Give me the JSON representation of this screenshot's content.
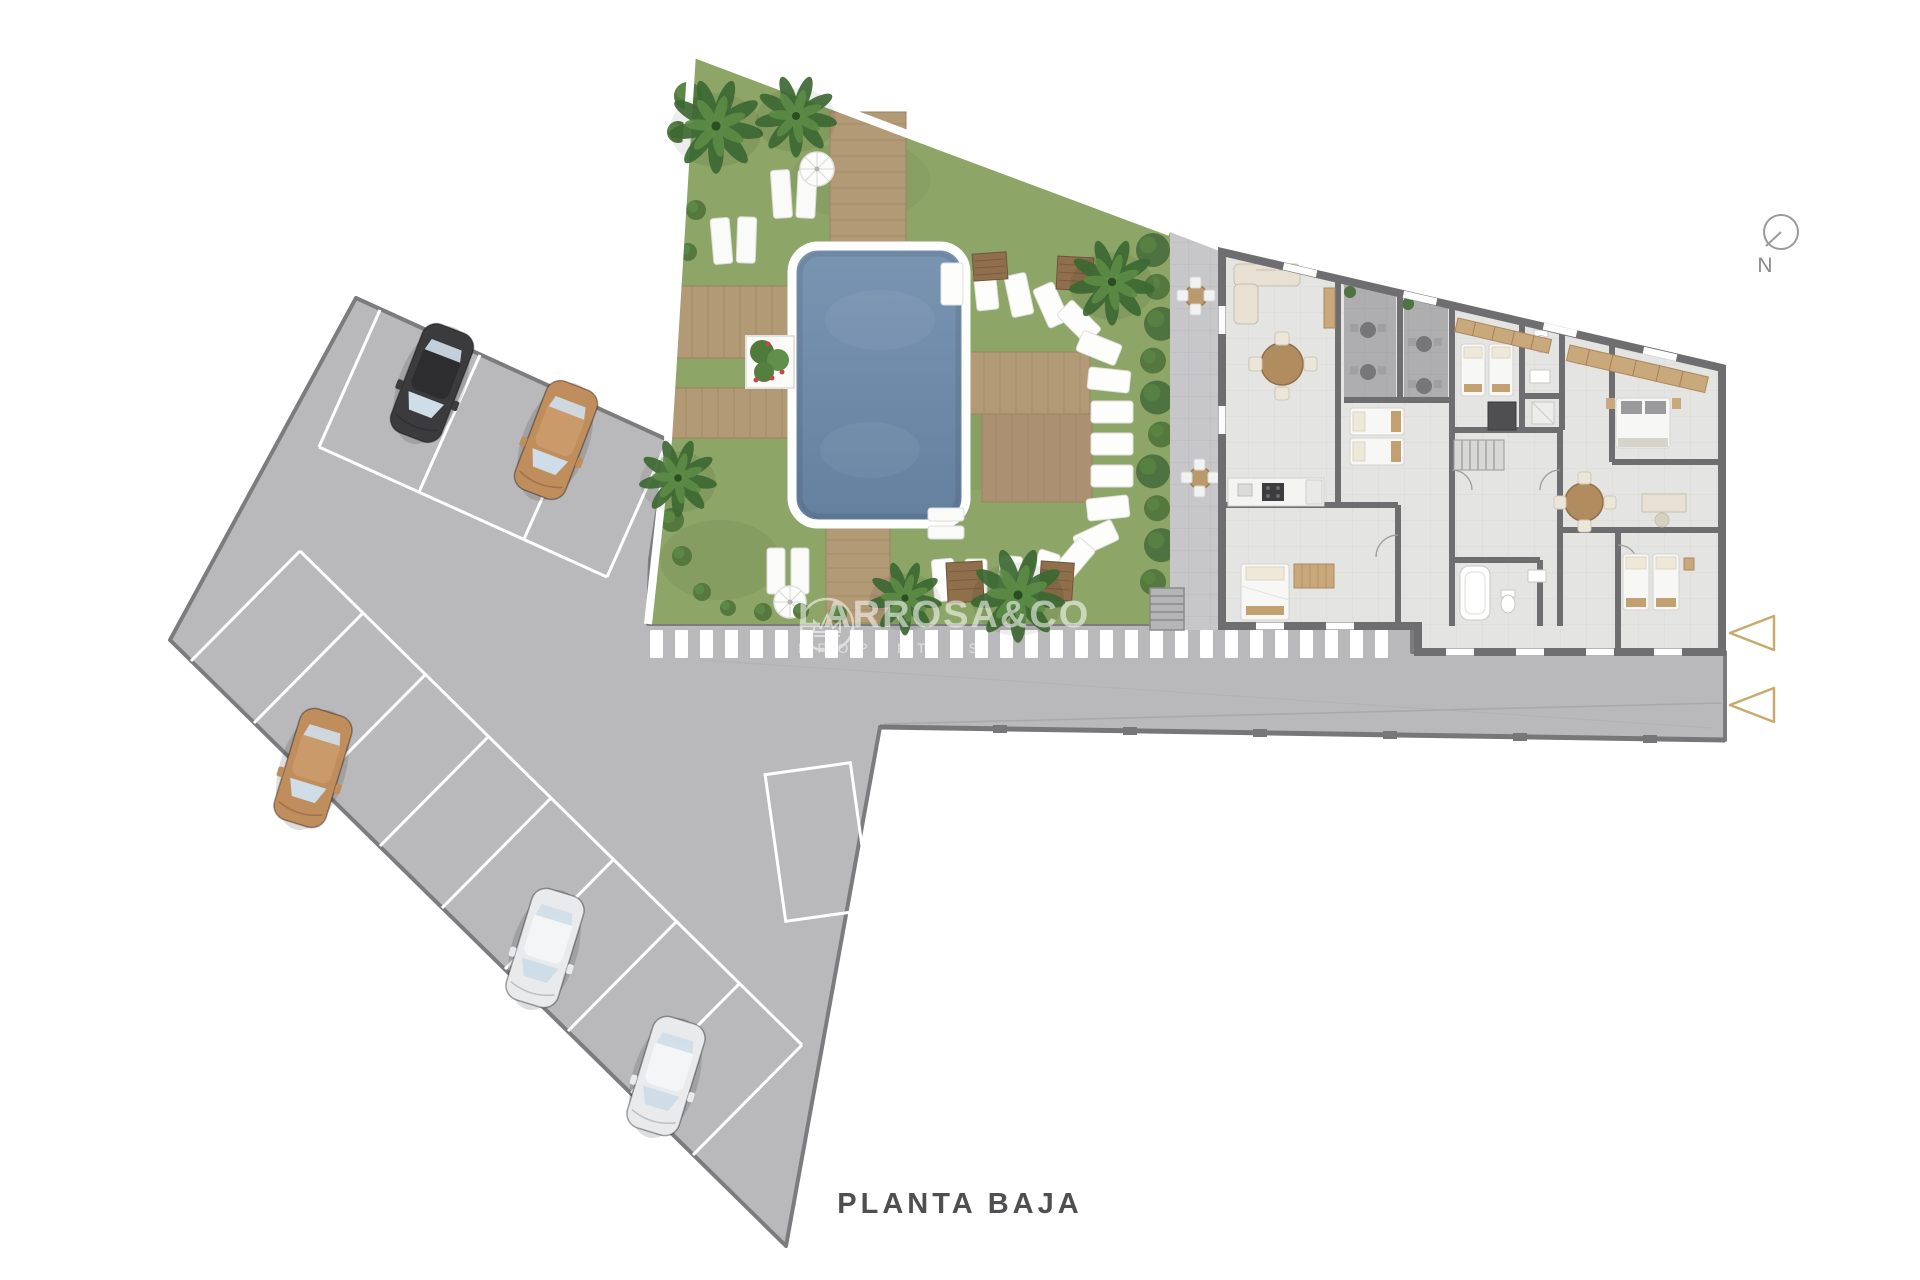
{
  "title": {
    "label": "PLANTA BAJA"
  },
  "watermark": {
    "brand": "LARROSA&CO",
    "tagline": "PROPERTIES",
    "logo": "crown-logo-icon"
  },
  "compass": {
    "label": "N"
  },
  "palette": {
    "background": "#ffffff",
    "pavement": "#b9b9bb",
    "pavement_border": "#7c7c7f",
    "stall_line": "#ffffff",
    "grass": "#8da667",
    "pool_water": "#7391af",
    "pool_water_deep": "#64809f",
    "coping": "#ffffff",
    "deck_wood": "#b39a77",
    "deck_line": "#9b8361",
    "palm_dark": "#3c6832",
    "palm_light": "#5c8c46",
    "bush": "#55783f",
    "hedge": "#4e7340",
    "wall": "#6e6e71",
    "floor": "#e4e4e2",
    "terrace_floor": "#aeaeb0",
    "courtyard": "#c7c7c9",
    "furniture_wood": "#b08c5e",
    "furniture_tan": "#c9a97c",
    "furniture_beige": "#e8e1d3",
    "bed_white": "#f7f7f5",
    "accent_tan": "#c9aa6d",
    "text": "#4f4f52",
    "watermark": "#ffffff"
  },
  "parking": {
    "cars": [
      {
        "color": "#3b3b3d",
        "roof": "#2d2d2f",
        "x": 432,
        "y": 383,
        "rot": 21
      },
      {
        "color": "#c08d5c",
        "roof": "#cb9a6b",
        "x": 556,
        "y": 440,
        "rot": 21
      },
      {
        "color": "#c08d5c",
        "roof": "#cb9a6b",
        "x": 313,
        "y": 768,
        "rot": 17
      },
      {
        "color": "#e8eaec",
        "roof": "#f3f5f6",
        "x": 545,
        "y": 948,
        "rot": 17
      },
      {
        "color": "#e8eaec",
        "roof": "#f3f5f6",
        "x": 666,
        "y": 1076,
        "rot": 17
      }
    ],
    "marked_bay": {
      "x": 818,
      "y": 842,
      "w": 86,
      "h": 148,
      "rot": -8
    }
  },
  "garden": {
    "palms": [
      {
        "x": 716,
        "y": 126,
        "r": 46
      },
      {
        "x": 796,
        "y": 116,
        "r": 40
      },
      {
        "x": 678,
        "y": 478,
        "r": 38
      },
      {
        "x": 905,
        "y": 598,
        "r": 36
      },
      {
        "x": 1018,
        "y": 595,
        "r": 46
      },
      {
        "x": 1112,
        "y": 282,
        "r": 42
      }
    ],
    "stones": [
      [
        952,
        284,
        0
      ],
      [
        986,
        289,
        -6
      ],
      [
        1019,
        295,
        -12
      ],
      [
        1051,
        305,
        -24
      ],
      [
        1079,
        322,
        -45
      ],
      [
        1099,
        348,
        -68
      ],
      [
        1109,
        380,
        -84
      ],
      [
        1112,
        412,
        -90
      ],
      [
        1112,
        444,
        -90
      ],
      [
        1112,
        476,
        -90
      ],
      [
        1108,
        508,
        -96
      ],
      [
        1096,
        538,
        -115
      ],
      [
        1074,
        560,
        -140
      ],
      [
        1044,
        572,
        -162
      ],
      [
        1010,
        577,
        -175
      ],
      [
        976,
        580,
        180
      ],
      [
        944,
        580,
        175
      ]
    ],
    "hedge": {
      "x": 1157,
      "y_start": 250,
      "y_end": 582,
      "count": 10
    },
    "bushes": [
      [
        688,
        96,
        14
      ],
      [
        678,
        132,
        11
      ],
      [
        696,
        210,
        10
      ],
      [
        688,
        252,
        9
      ],
      [
        672,
        520,
        12
      ],
      [
        682,
        556,
        10
      ],
      [
        702,
        592,
        9
      ],
      [
        728,
        608,
        8
      ],
      [
        763,
        612,
        9
      ],
      [
        801,
        611,
        8
      ],
      [
        838,
        614,
        9
      ],
      [
        1180,
        250,
        8
      ],
      [
        1214,
        560,
        7
      ]
    ]
  },
  "road": {
    "crosswalk": {
      "x0": 650,
      "x1": 1408,
      "y": 630,
      "height": 28,
      "stripe_w": 13,
      "gap": 12
    }
  },
  "entrance_arrows": {
    "icon": "triangle-left-icon",
    "size": 44,
    "positions": [
      {
        "x": 1730,
        "y": 633
      },
      {
        "x": 1730,
        "y": 705
      }
    ]
  }
}
